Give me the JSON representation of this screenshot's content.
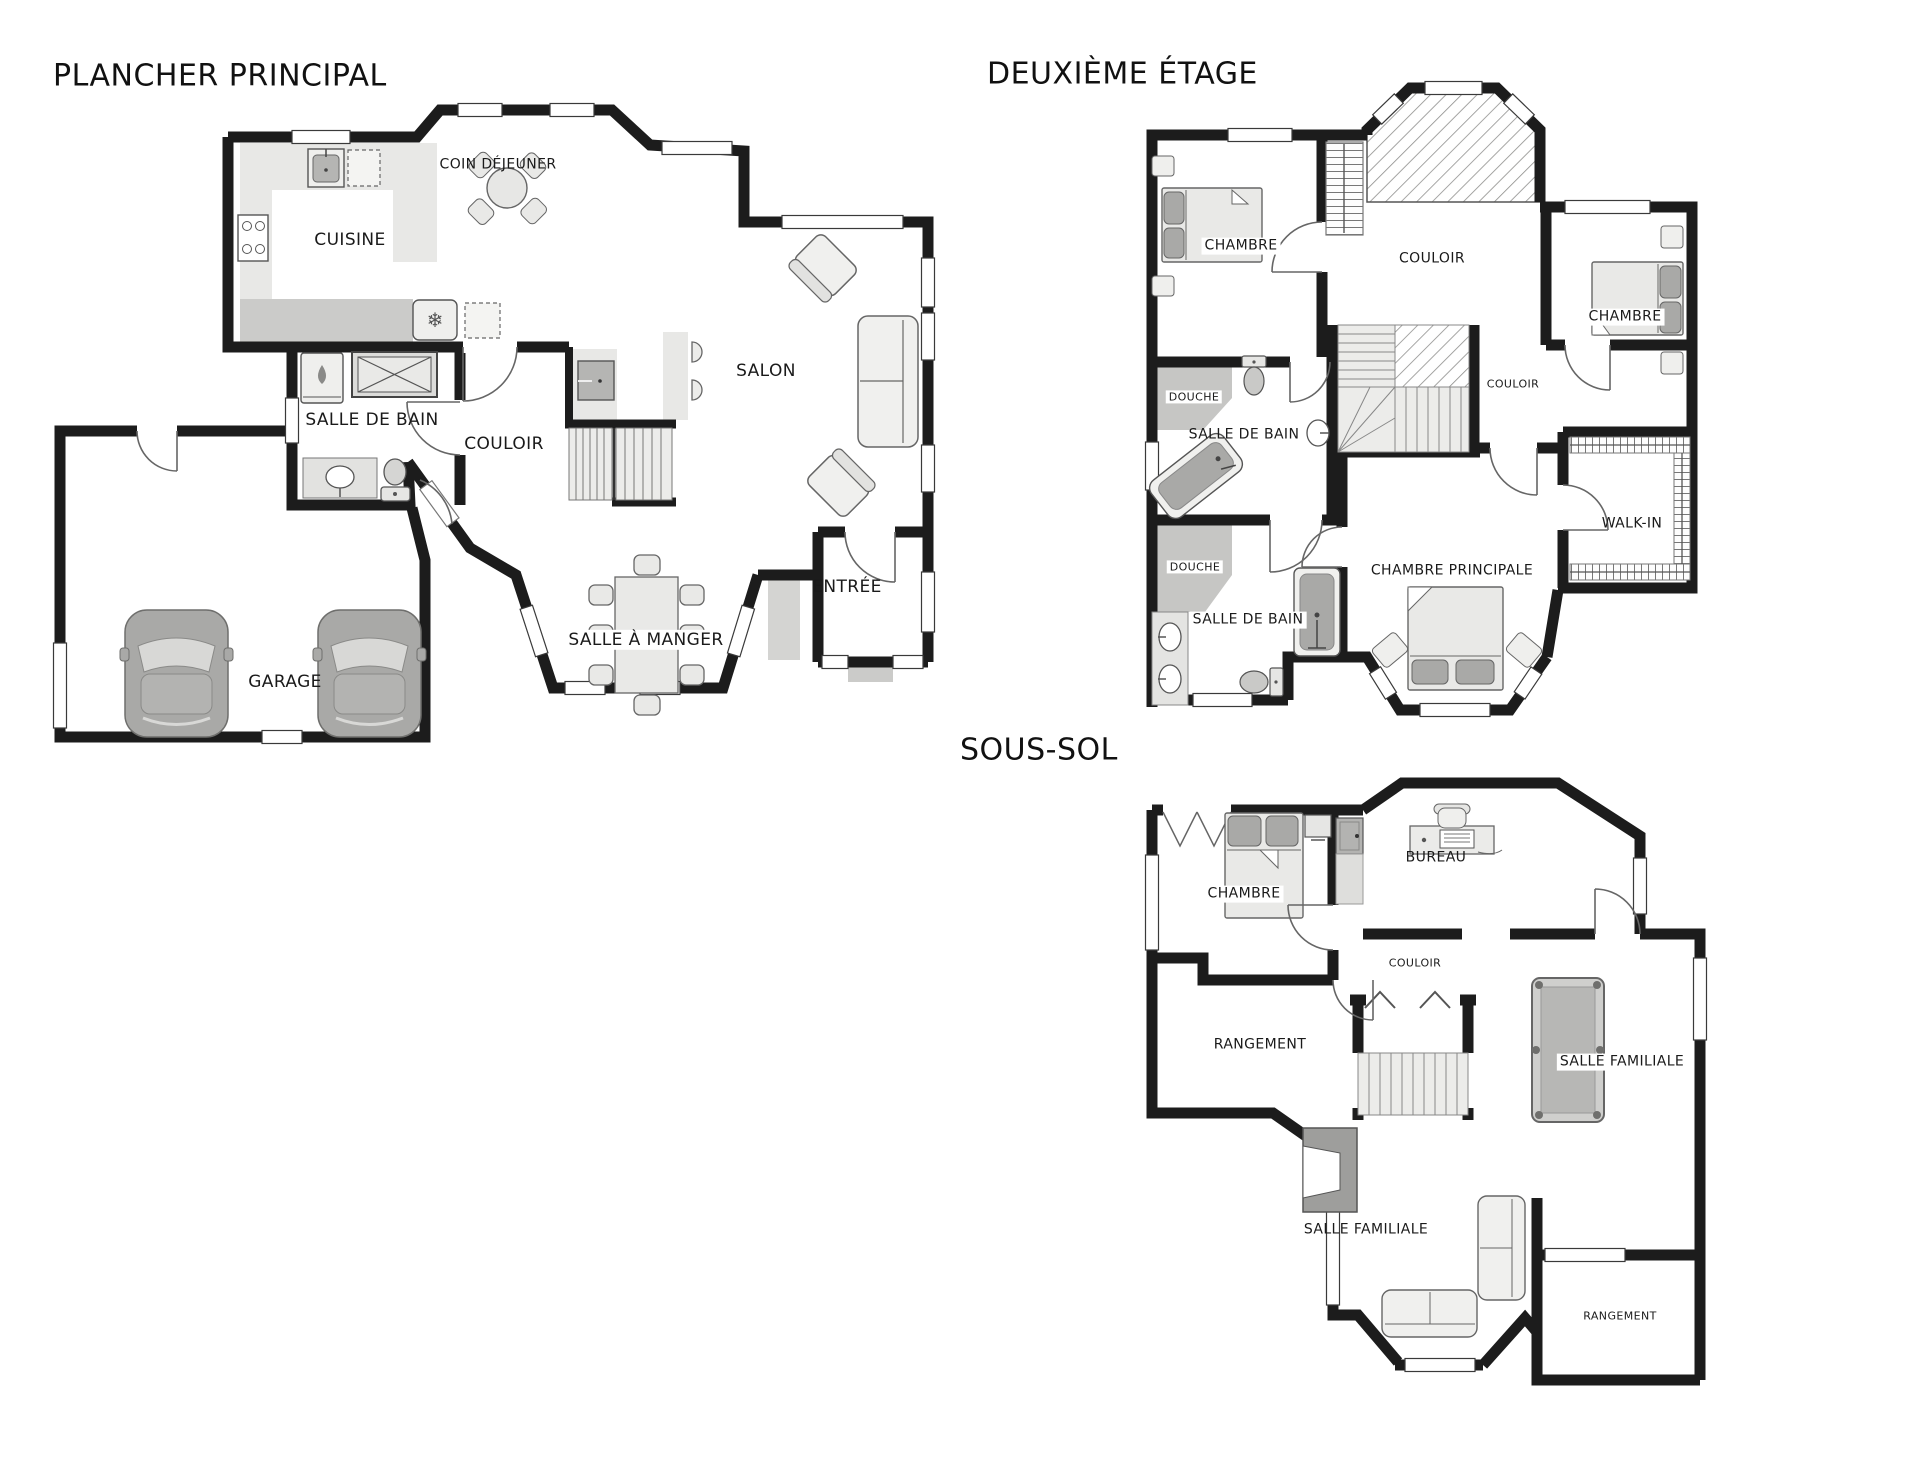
{
  "document": {
    "type": "real-estate floor plan, 3 levels",
    "language": "French"
  },
  "colors": {
    "background": "#ffffff",
    "wall": "#1c1c1c",
    "thin_line": "#555555",
    "counter_light": "#e8e8e6",
    "counter_mid": "#cbcbc9",
    "shower_gray": "#c6c6c4",
    "fixture_dark": "#a9a9a7",
    "cellar_dark": "#9e9e9c",
    "furniture_fill": "#f0f0ee",
    "car_gray": "#a9a9a7"
  },
  "glyphs": {
    "fridge": "❄"
  },
  "floors": {
    "main": {
      "title": "PLANCHER PRINCIPAL",
      "rooms": {
        "coin_dejeuner": "COIN DÉJEUNER",
        "cuisine": "CUISINE",
        "salle_de_bain": "SALLE DE BAIN",
        "couloir": "COULOIR",
        "salon": "SALON",
        "salle_a_manger": "SALLE À MANGER",
        "entree": "ENTRÉE",
        "garage": "GARAGE"
      }
    },
    "second": {
      "title": "DEUXIÈME ÉTAGE",
      "rooms": {
        "chambre_1": "CHAMBRE",
        "couloir": "COULOIR",
        "chambre_2": "CHAMBRE",
        "couloir_2": "COULOIR",
        "douche_1": "DOUCHE",
        "salle_de_bain_1": "SALLE DE BAIN",
        "douche_2": "DOUCHE",
        "salle_de_bain_2": "SALLE DE BAIN",
        "walk_in": "WALK-IN",
        "chambre_principale": "CHAMBRE PRINCIPALE"
      }
    },
    "basement": {
      "title": "SOUS-SOL",
      "rooms": {
        "chambre": "CHAMBRE",
        "bureau": "BUREAU",
        "couloir": "COULOIR",
        "rangement_1": "RANGEMENT",
        "salle_familiale_1": "SALLE FAMILIALE",
        "salle_familiale_2": "SALLE FAMILIALE",
        "rangement_2": "RANGEMENT"
      }
    }
  }
}
